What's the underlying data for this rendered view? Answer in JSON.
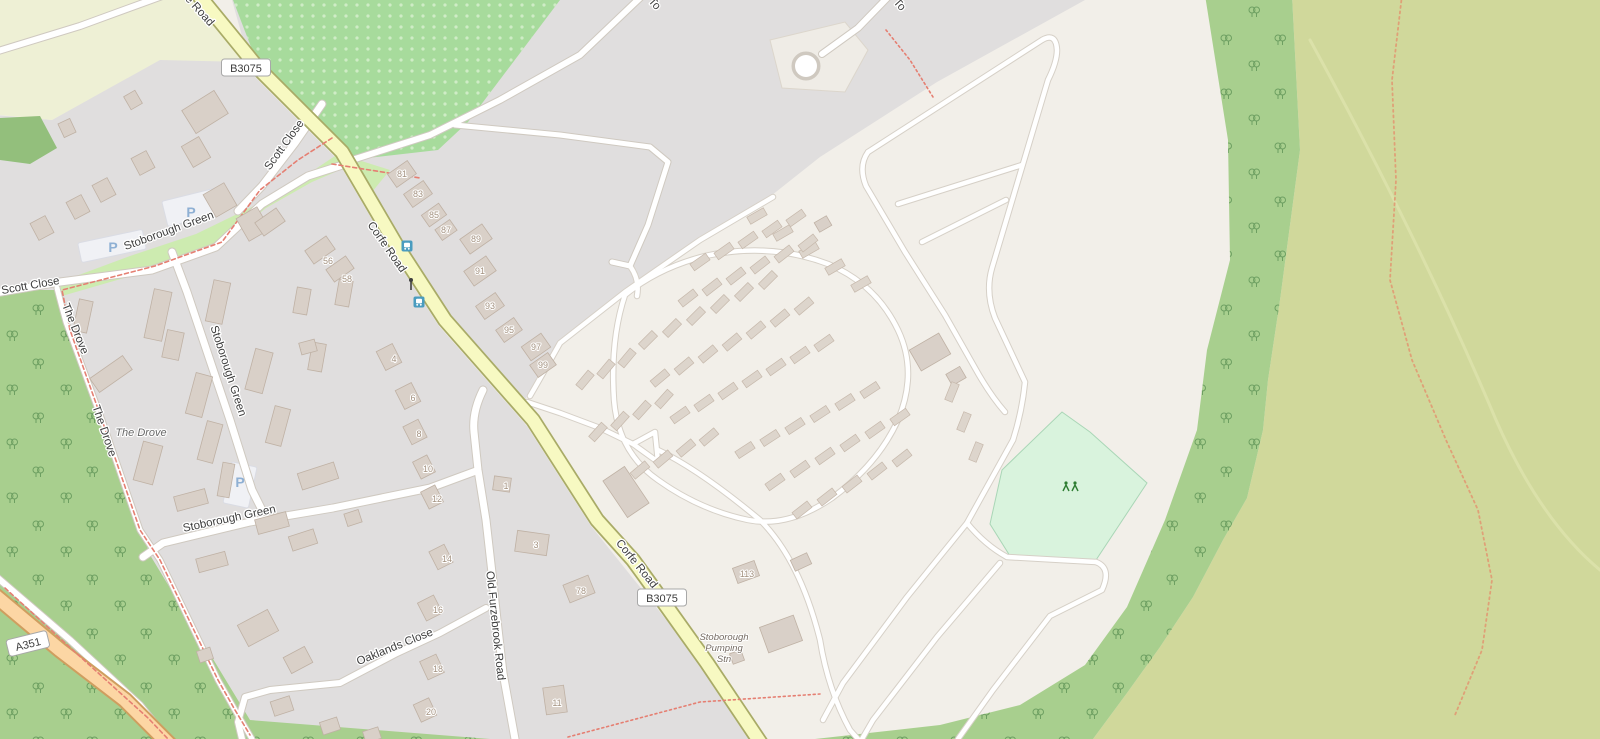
{
  "map": {
    "street_labels": [
      {
        "text": "e Road",
        "x": 197,
        "y": 13,
        "rot": 48
      },
      {
        "text": "Scott Close",
        "x": 287,
        "y": 147,
        "rot": -54
      },
      {
        "text": "Stoborough Green",
        "x": 170,
        "y": 234,
        "rot": -20
      },
      {
        "text": "Scott Close",
        "x": 31,
        "y": 289,
        "rot": -10
      },
      {
        "text": "The Drove",
        "x": 72,
        "y": 330,
        "rot": 68
      },
      {
        "text": "Stoborough Green",
        "x": 225,
        "y": 372,
        "rot": 72
      },
      {
        "text": "The Drove",
        "x": 101,
        "y": 432,
        "rot": 71
      },
      {
        "text": "Stoborough Green",
        "x": 230,
        "y": 522,
        "rot": -12
      },
      {
        "text": "Corfe Road",
        "x": 384,
        "y": 249,
        "rot": 55
      },
      {
        "text": "Corfe Road",
        "x": 634,
        "y": 566,
        "rot": 51
      },
      {
        "text": "Oaklands Close",
        "x": 396,
        "y": 650,
        "rot": -22
      },
      {
        "text": "Old Furzebrook Road",
        "x": 492,
        "y": 626,
        "rot": 84
      },
      {
        "text": "To",
        "x": 652,
        "y": 6,
        "rot": 48
      },
      {
        "text": "To",
        "x": 897,
        "y": 7,
        "rot": 48
      }
    ],
    "route_badges": [
      {
        "text": "B3075",
        "x": 246,
        "y": 68,
        "rot": 0
      },
      {
        "text": "B3075",
        "x": 662,
        "y": 598,
        "rot": 0
      },
      {
        "text": "A351",
        "x": 28,
        "y": 644,
        "rot": -14
      }
    ],
    "place_labels": [
      {
        "text": "The Drove",
        "x": 141,
        "y": 436
      }
    ],
    "poi_label": {
      "lines": [
        "Stoborough",
        "Pumping",
        "Stn"
      ],
      "x": 724,
      "y": 640,
      "line_height": 11
    },
    "house_numbers": [
      {
        "text": "81",
        "x": 402,
        "y": 177
      },
      {
        "text": "83",
        "x": 418,
        "y": 197
      },
      {
        "text": "85",
        "x": 434,
        "y": 218
      },
      {
        "text": "87",
        "x": 446,
        "y": 233
      },
      {
        "text": "89",
        "x": 476,
        "y": 242
      },
      {
        "text": "91",
        "x": 480,
        "y": 274
      },
      {
        "text": "93",
        "x": 490,
        "y": 309
      },
      {
        "text": "95",
        "x": 509,
        "y": 333
      },
      {
        "text": "97",
        "x": 536,
        "y": 350
      },
      {
        "text": "99",
        "x": 543,
        "y": 368
      },
      {
        "text": "56",
        "x": 328,
        "y": 264
      },
      {
        "text": "58",
        "x": 347,
        "y": 282
      },
      {
        "text": "4",
        "x": 394,
        "y": 362
      },
      {
        "text": "6",
        "x": 413,
        "y": 401
      },
      {
        "text": "8",
        "x": 419,
        "y": 437
      },
      {
        "text": "10",
        "x": 428,
        "y": 472
      },
      {
        "text": "12",
        "x": 437,
        "y": 502
      },
      {
        "text": "14",
        "x": 447,
        "y": 562
      },
      {
        "text": "16",
        "x": 438,
        "y": 613
      },
      {
        "text": "18",
        "x": 438,
        "y": 672
      },
      {
        "text": "20",
        "x": 431,
        "y": 715
      },
      {
        "text": "1",
        "x": 506,
        "y": 489
      },
      {
        "text": "3",
        "x": 536,
        "y": 548
      },
      {
        "text": "78",
        "x": 581,
        "y": 594
      },
      {
        "text": "11",
        "x": 557,
        "y": 706
      },
      {
        "text": "113",
        "x": 747,
        "y": 577
      }
    ],
    "parking_letter": "P",
    "parking_symbols": [
      {
        "x": 191,
        "y": 217
      },
      {
        "x": 113,
        "y": 252
      },
      {
        "x": 240,
        "y": 487
      }
    ],
    "bus_stops": [
      {
        "x": 407,
        "y": 246
      },
      {
        "x": 419,
        "y": 302
      }
    ],
    "icons": {
      "playground": {
        "x": 1070,
        "y": 488
      },
      "traffic_signal": {
        "x": 411,
        "y": 285
      }
    },
    "colors": {
      "base_land": "#f2efe9",
      "residential": "#e0dede",
      "farmland": "#eef0d5",
      "orchard": "#a7db9c",
      "woodland": "#a8cf8e",
      "heath": "#d0d89b",
      "grass": "#cdebb0",
      "recreation_ground": "#d9f3dd",
      "secondary_road": "#f7f9c2",
      "primary_road": "#fcd6a4",
      "minor_road": "#ffffff",
      "building": "#d9d0c8",
      "footpath_red": "#e57f72",
      "track_orange": "#dfa077",
      "parking_blue": "#8fb0d4",
      "bus_icon": "#4a9cbf",
      "playground_icon": "#2e7d32"
    }
  }
}
